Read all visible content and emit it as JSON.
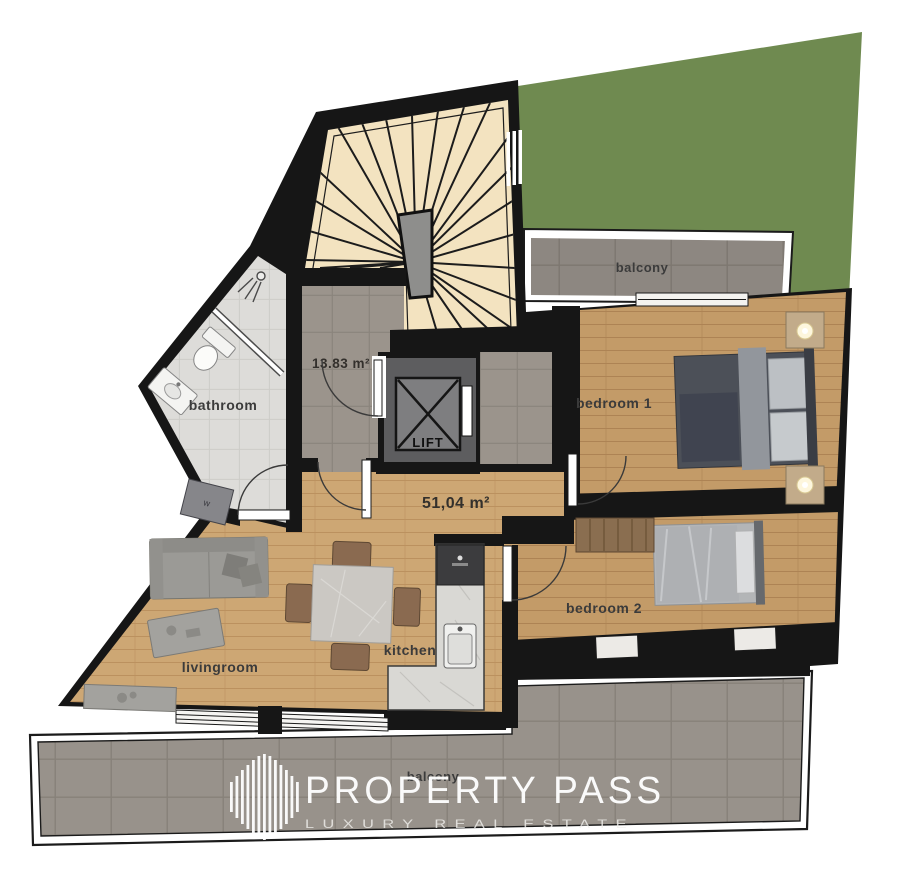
{
  "labels": {
    "balcony_top": "balcony",
    "balcony_bottom": "balcony",
    "bedroom1": "bedroom 1",
    "bedroom2": "bedroom 2",
    "bathroom": "bathroom",
    "livingroom": "livingroom",
    "kitchen": "kitchen",
    "lift": "LIFT",
    "stair_hall_area": "13.83 m²",
    "main_area": "51,04 m²",
    "washer": "w"
  },
  "watermark": {
    "brand": "PROPERTY PASS",
    "tagline": "LUXURY REAL ESTATE"
  },
  "colors": {
    "garden": "#6f8a50",
    "wall": "#161616",
    "wood_living": "#cda774",
    "wood_bedroom": "#c39b68",
    "stairs": "#f3e3c0",
    "hall_tile": "#9b948c",
    "balcony_tile": "#98928b",
    "bath_tile": "#dddcd9",
    "counter": "#d9d8d4"
  }
}
